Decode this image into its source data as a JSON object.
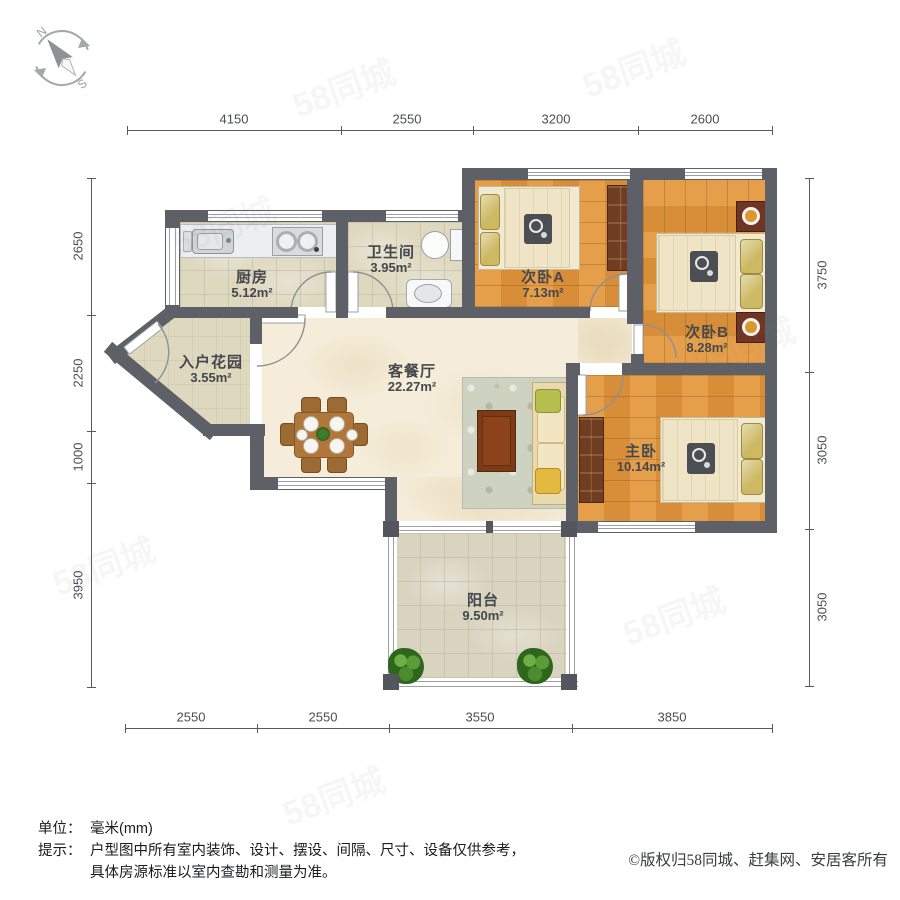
{
  "compass": {
    "north": "N",
    "south": "S"
  },
  "dimensions": {
    "top": [
      "4150",
      "2550",
      "3200",
      "2600"
    ],
    "bottom": [
      "2550",
      "2550",
      "3550",
      "3850"
    ],
    "left": [
      "2650",
      "2250",
      "1000",
      "3950"
    ],
    "right": [
      "3750",
      "3050",
      "3050"
    ]
  },
  "rooms": {
    "kitchen": {
      "name": "厨房",
      "area": "5.12m²"
    },
    "bathroom": {
      "name": "卫生间",
      "area": "3.95m²"
    },
    "bedroom_a": {
      "name": "次卧A",
      "area": "7.13m²"
    },
    "bedroom_b": {
      "name": "次卧B",
      "area": "8.28m²"
    },
    "master_bedroom": {
      "name": "主卧",
      "area": "10.14m²"
    },
    "living_dining": {
      "name": "客餐厅",
      "area": "22.27m²"
    },
    "entry_garden": {
      "name": "入户花园",
      "area": "3.55m²"
    },
    "balcony": {
      "name": "阳台",
      "area": "9.50m²"
    }
  },
  "footer": {
    "unit_label": "单位：",
    "unit_value": "毫米(mm)",
    "tip_label": "提示：",
    "tip_line1": "户型图中所有室内装饰、设计、摆设、间隔、尺寸、设备仅供参考，",
    "tip_line2": "具体房源标准以室内查勘和测量为准。",
    "copyright": "©版权归58同城、赶集网、安居客所有"
  },
  "watermark": {
    "text": "58同城"
  },
  "colors": {
    "wall": "#5d6167",
    "wood_floor": "#e0943c",
    "tile_floor": "#ded8bf",
    "living_floor": "#f5edda",
    "balcony_floor": "#d9d4c0",
    "label_text": "#45484c"
  }
}
